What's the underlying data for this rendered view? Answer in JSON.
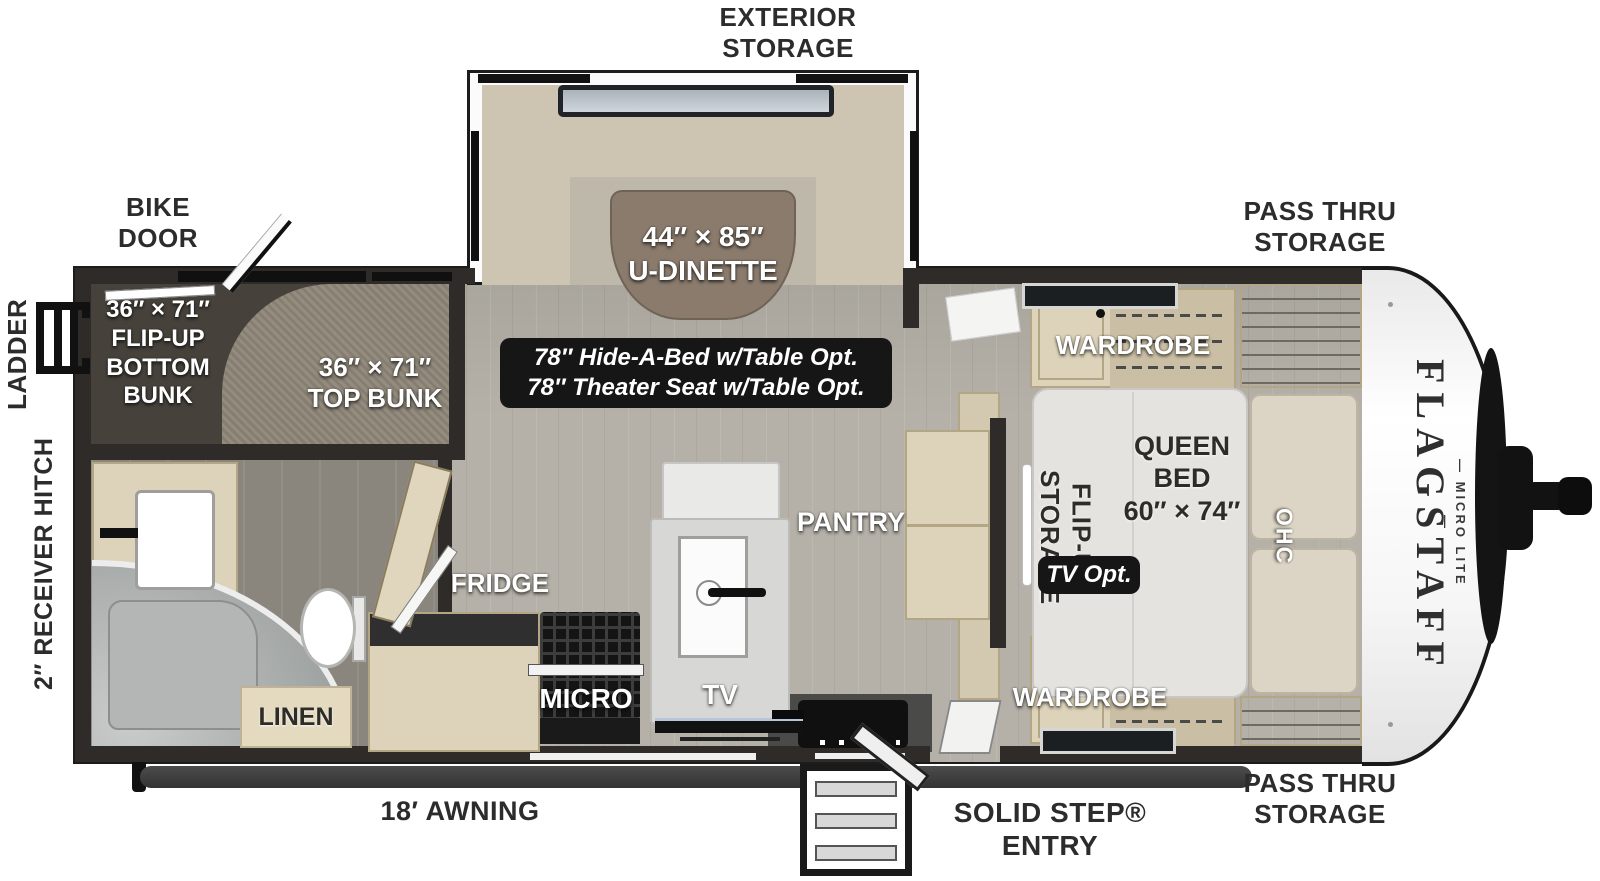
{
  "meta": {
    "title": "Flagstaff Micro Lite travel trailer floor plan"
  },
  "colors": {
    "wall": "#2e2b28",
    "floor": "#b5b1a8",
    "bath_floor": "#8a867d",
    "carpet": "#8e8678",
    "bunk_dark": "#46423b",
    "cabinet_wood": "#ddd3ba",
    "dinette_bench": "#cdc5b2",
    "dinette_table": "#8a7b6d",
    "mattress": "#e4e3df",
    "badge_bg": "#161616",
    "label_dark": "#2c2c2c",
    "label_light": "#ffffff",
    "front_cap": "#f4f4f4"
  },
  "exterior": {
    "exterior_storage": "EXTERIOR\nSTORAGE",
    "bike_door": "BIKE\nDOOR",
    "pass_thru_storage_top": "PASS THRU\nSTORAGE",
    "pass_thru_storage_bottom": "PASS THRU\nSTORAGE",
    "ladder": "LADDER",
    "receiver_hitch": "2″ RECEIVER HITCH",
    "awning": "18′ AWNING",
    "solid_step_entry": "SOLID STEP®\nENTRY"
  },
  "interior": {
    "u_dinette": "44″ × 85″\nU-DINETTE",
    "flip_up_bottom_bunk": "36″ × 71″\nFLIP-UP\nBOTTOM\nBUNK",
    "top_bunk": "36″ × 71″\nTOP BUNK",
    "wardrobe_top": "WARDROBE",
    "wardrobe_bottom": "WARDROBE",
    "queen_bed": "QUEEN\nBED\n60″ × 74″",
    "flip_up_storage": "FLIP-UP\nSTORAGE",
    "ohc": "OHC",
    "pantry": "PANTRY",
    "fridge": "FRIDGE",
    "micro": "MICRO",
    "tv": "TV",
    "linen": "LINEN"
  },
  "badges": {
    "hide_a_bed": "78″ Hide-A-Bed w/Table Opt.\n78″ Theater Seat w/Table Opt.",
    "tv_opt": "TV Opt."
  },
  "brand": {
    "name": "FLAGSTAFF",
    "subtitle": "— MICRO LITE —"
  }
}
